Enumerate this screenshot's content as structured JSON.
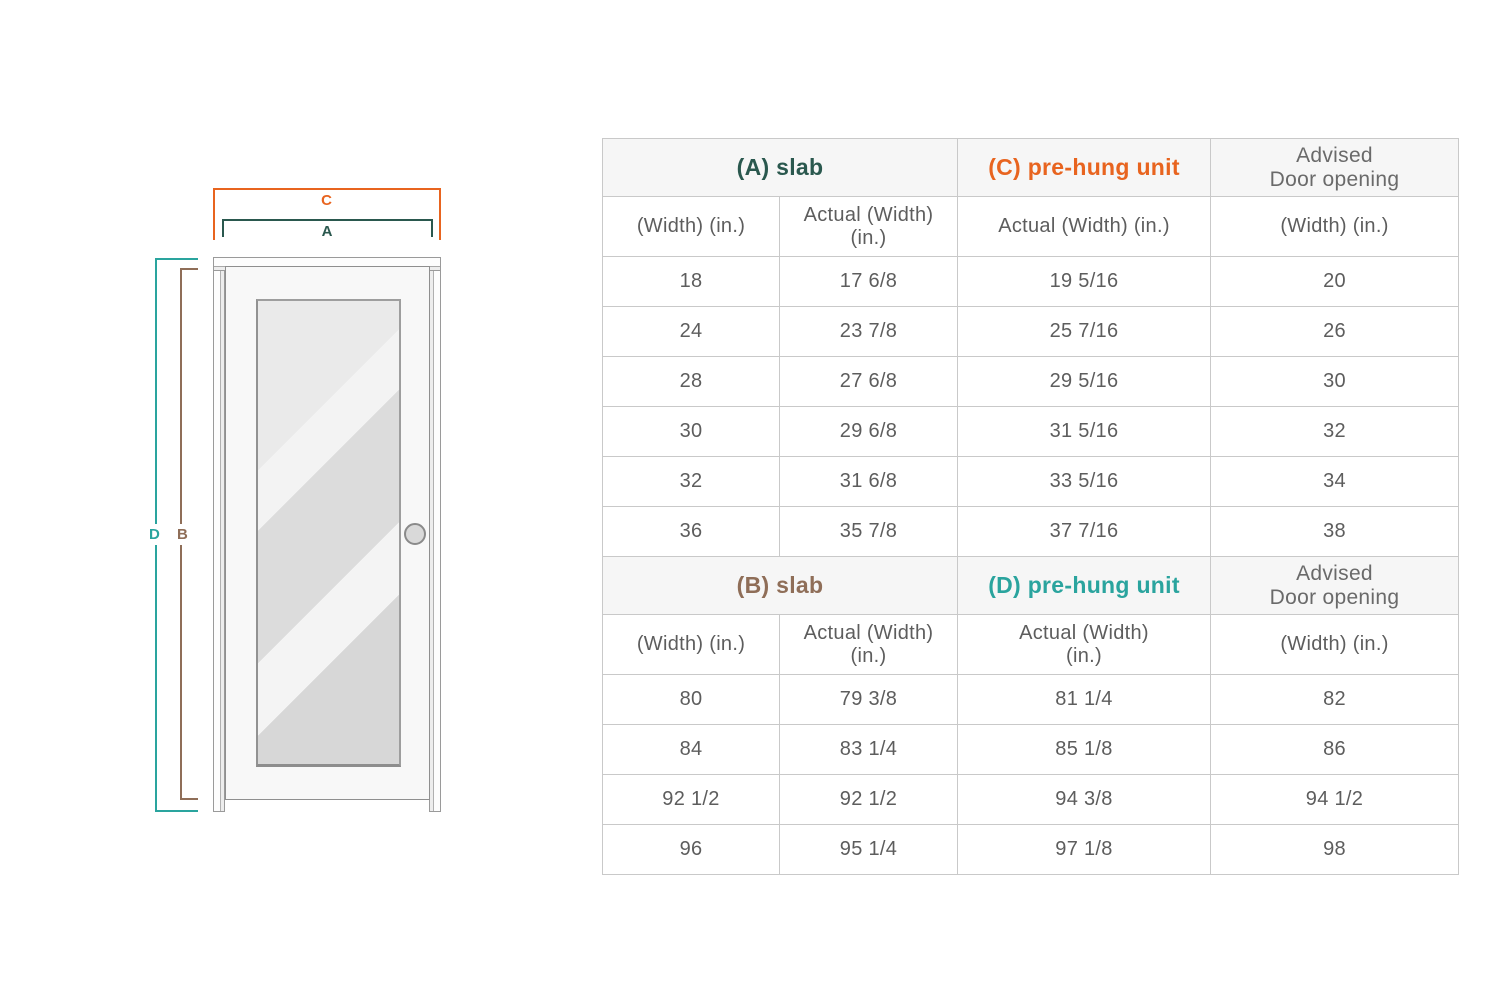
{
  "diagram": {
    "dim_c": {
      "label": "C",
      "color": "#e8641f"
    },
    "dim_a": {
      "label": "A",
      "color": "#2a584e"
    },
    "dim_d": {
      "label": "D",
      "color": "#2aa49e"
    },
    "dim_b": {
      "label": "B",
      "color": "#8f6e58"
    }
  },
  "table": {
    "sections": [
      {
        "headers": [
          {
            "label": "(A) slab",
            "color": "#2a584e",
            "colspan": 2,
            "advised": false
          },
          {
            "label": "(C) pre-hung unit",
            "color": "#e8641f",
            "colspan": 1,
            "advised": false
          },
          {
            "label": "Advised\nDoor opening",
            "color": "#6a6a6a",
            "colspan": 1,
            "advised": true
          }
        ],
        "subheaders": [
          "(Width) (in.)",
          "Actual (Width)\n(in.)",
          "Actual (Width) (in.)",
          "(Width) (in.)"
        ],
        "rows": [
          [
            "18",
            "17 6/8",
            "19 5/16",
            "20"
          ],
          [
            "24",
            "23 7/8",
            "25 7/16",
            "26"
          ],
          [
            "28",
            "27 6/8",
            "29 5/16",
            "30"
          ],
          [
            "30",
            "29 6/8",
            "31 5/16",
            "32"
          ],
          [
            "32",
            "31 6/8",
            "33 5/16",
            "34"
          ],
          [
            "36",
            "35 7/8",
            "37 7/16",
            "38"
          ]
        ]
      },
      {
        "headers": [
          {
            "label": "(B) slab",
            "color": "#8f6e58",
            "colspan": 2,
            "advised": false
          },
          {
            "label": "(D) pre-hung unit",
            "color": "#2aa49e",
            "colspan": 1,
            "advised": false
          },
          {
            "label": "Advised\nDoor opening",
            "color": "#6a6a6a",
            "colspan": 1,
            "advised": true
          }
        ],
        "subheaders": [
          "(Width) (in.)",
          "Actual (Width)\n(in.)",
          "Actual (Width)\n(in.)",
          "(Width) (in.)"
        ],
        "rows": [
          [
            "80",
            "79 3/8",
            "81 1/4",
            "82"
          ],
          [
            "84",
            "83 1/4",
            "85 1/8",
            "86"
          ],
          [
            "92 1/2",
            "92 1/2",
            "94 3/8",
            "94 1/2"
          ],
          [
            "96",
            "95 1/4",
            "97 1/8",
            "98"
          ]
        ]
      }
    ]
  }
}
